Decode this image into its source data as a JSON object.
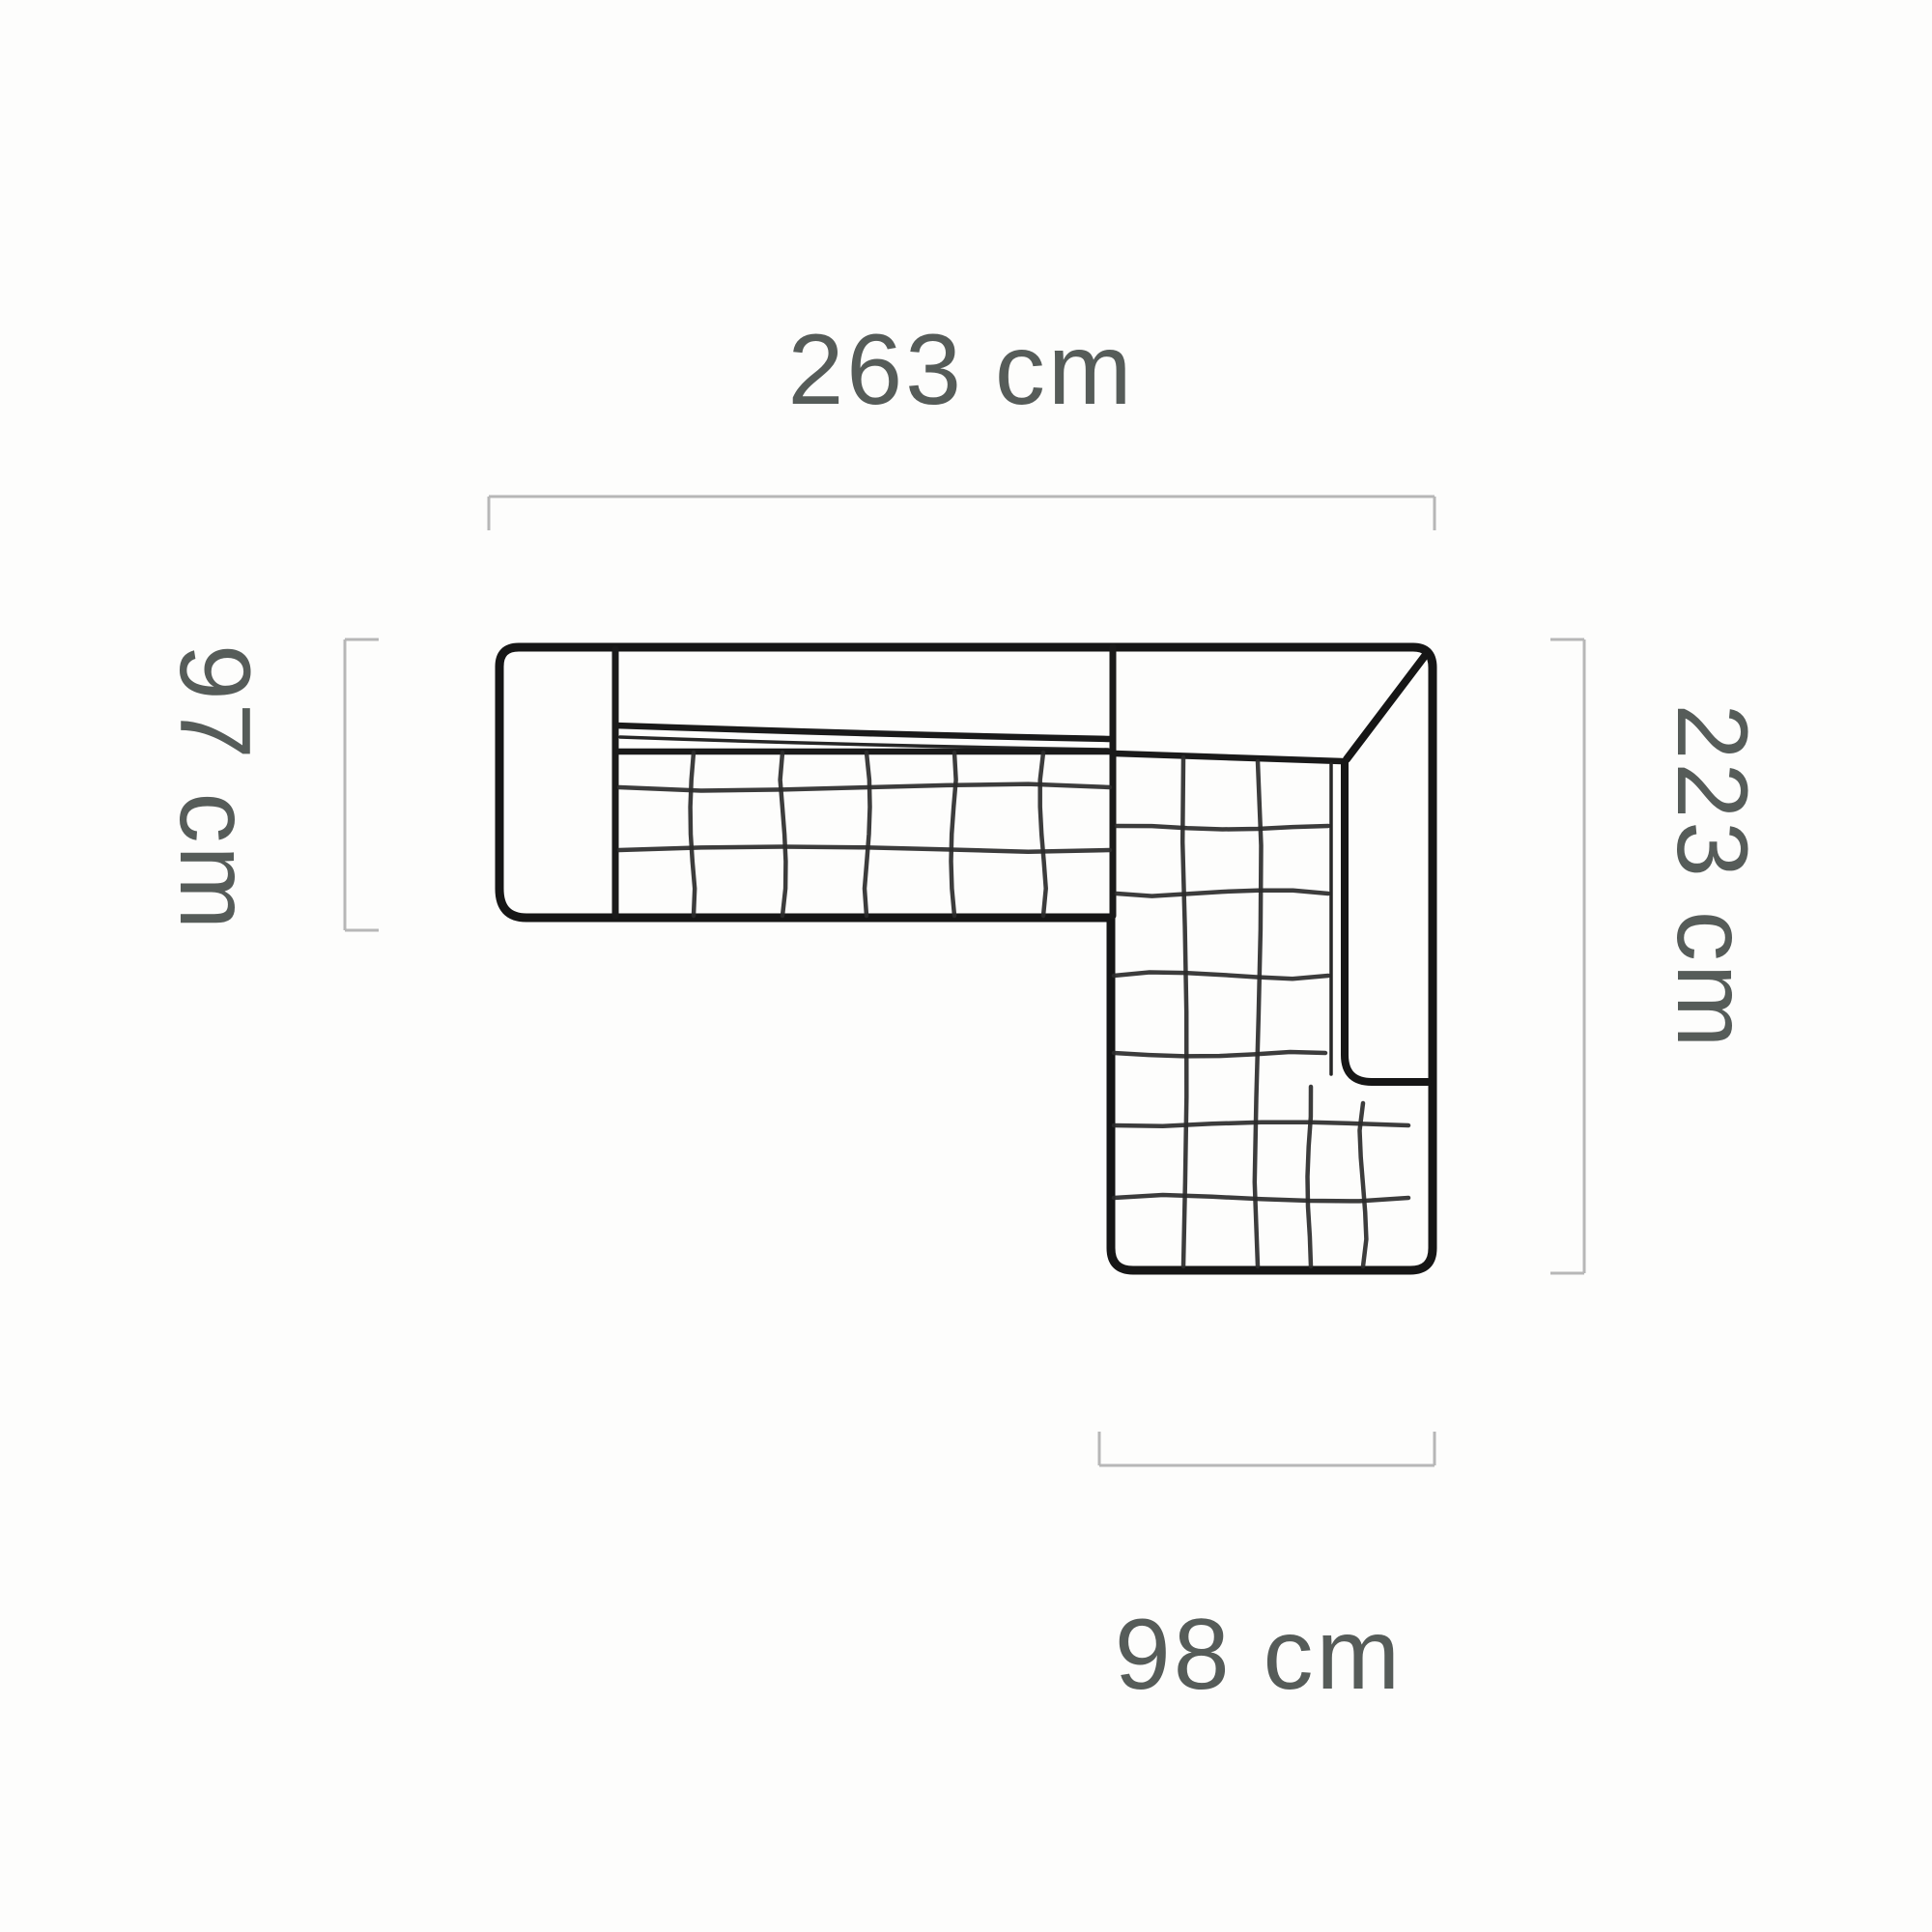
{
  "page": {
    "background": "#fdfdfc",
    "description": "Top-view line drawing of an L-shaped corner sofa with overall dimensions"
  },
  "diagram": {
    "type": "sofa-top-view-dimension-drawing",
    "unit": "cm",
    "dimensions": {
      "top": {
        "label": "263 cm",
        "value": 263,
        "side": "top"
      },
      "left": {
        "label": "97 cm",
        "value": 97,
        "side": "left"
      },
      "right": {
        "label": "223 cm",
        "value": 223,
        "side": "right"
      },
      "bottom": {
        "label": "98 cm",
        "value": 98,
        "side": "bottom"
      }
    },
    "colors": {
      "sofa_outline": "#161616",
      "quilt_lines": "#2b2b2b",
      "dimension_lines": "#b7b7b7",
      "label_text": "#565c59"
    }
  }
}
